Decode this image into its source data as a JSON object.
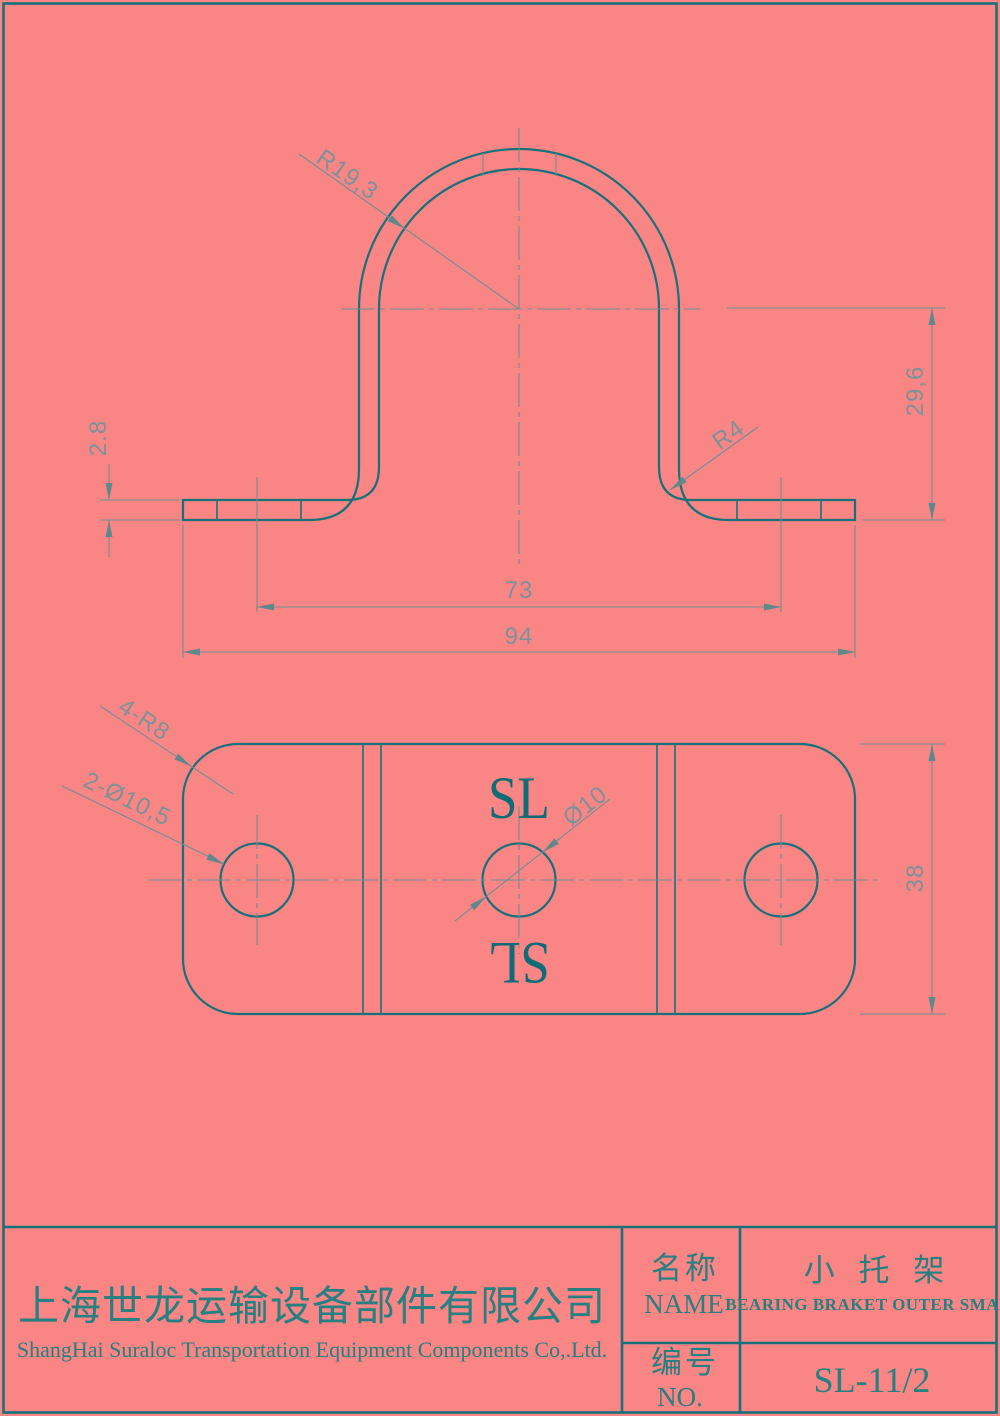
{
  "page": {
    "background": "#fa8585",
    "line_color": "#17707a",
    "dim_color": "#6f8f93",
    "text_color": "#267f80"
  },
  "front_view": {
    "dimensions": {
      "arch_radius": "R19,3",
      "thickness": "2.8",
      "bend_radius": "R4",
      "height": "29,6",
      "hole_spacing": "73",
      "overall_width": "94"
    }
  },
  "flat_view": {
    "dimensions": {
      "corner_radius": "4-R8",
      "outer_holes": "2-Ø10,5",
      "center_hole": "Ø10",
      "plate_width": "38"
    },
    "logo": "SL",
    "logo_mirrored": "SL"
  },
  "title_block": {
    "company_cn": "上海世龙运输设备部件有限公司",
    "company_en": "ShangHai Suraloc Transportation Equipment Components Co,.Ltd.",
    "name_label_cn": "名称",
    "name_label_en": "NAME",
    "part_name_cn": "小 托 架",
    "part_name_en": "BEARING BRAKET OUTER SMALL",
    "no_label_cn": "编号",
    "no_label_en": "NO.",
    "part_number": "SL-11/2"
  }
}
